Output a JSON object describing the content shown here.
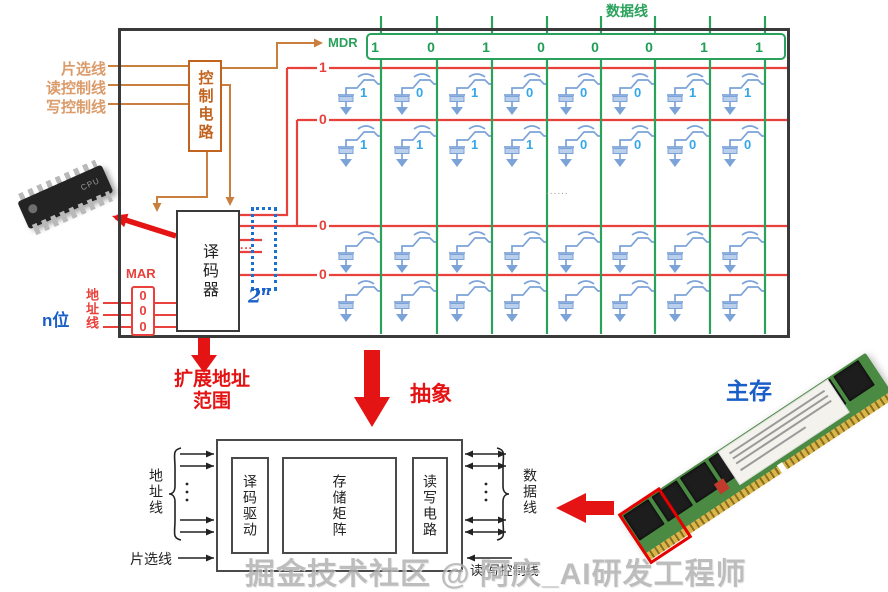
{
  "top_diagram": {
    "data_bus_label": "数据线",
    "mdr_label": "MDR",
    "mdr_bits": [
      "1",
      "0",
      "1",
      "0",
      "0",
      "0",
      "1",
      "1"
    ],
    "input_labels": [
      "片选线",
      "读控制线",
      "写控制线"
    ],
    "control_circuit": "控制电路",
    "decoder": "译码器",
    "mar_label": "MAR",
    "mar_bits": [
      "0",
      "0",
      "0"
    ],
    "address_width": "n位",
    "address_bus": "地址线",
    "rows": [
      {
        "word_line": "1",
        "cells": [
          "1",
          "0",
          "1",
          "0",
          "0",
          "0",
          "1",
          "1"
        ]
      },
      {
        "word_line": "0",
        "cells": [
          "1",
          "1",
          "1",
          "1",
          "0",
          "0",
          "0",
          "0"
        ]
      },
      {
        "word_line": "0",
        "cells": []
      },
      {
        "word_line": "0",
        "cells": []
      }
    ],
    "row_ellipsis": "......",
    "decoder_out_ellipsis": "...",
    "decoder_out_count_base": "2",
    "decoder_out_count_exp": "n",
    "chip_text": "CPU"
  },
  "annotations": {
    "expand_addr_1": "扩展地址",
    "expand_addr_2": "范围",
    "abstract": "抽象",
    "main_memory": "主存"
  },
  "bottom_diagram": {
    "address_lines": "地址线",
    "chip_select": "片选线",
    "blocks": [
      "译码驱动",
      "存储矩阵",
      "读写电路"
    ],
    "data_lines": "数据线",
    "rw_control": "读/写控制线"
  },
  "watermark": "掘金技术社区 @ 阿庆_AI研发工程师",
  "colors": {
    "wire_red": "#e8413c",
    "wire_green": "#2aa25c",
    "wire_orange": "#c9803f",
    "accent_blue": "#1a5fc8",
    "cell_blue": "#7ba3d8",
    "cell_value": "#35a7e8",
    "annotation_red": "#e51414"
  }
}
